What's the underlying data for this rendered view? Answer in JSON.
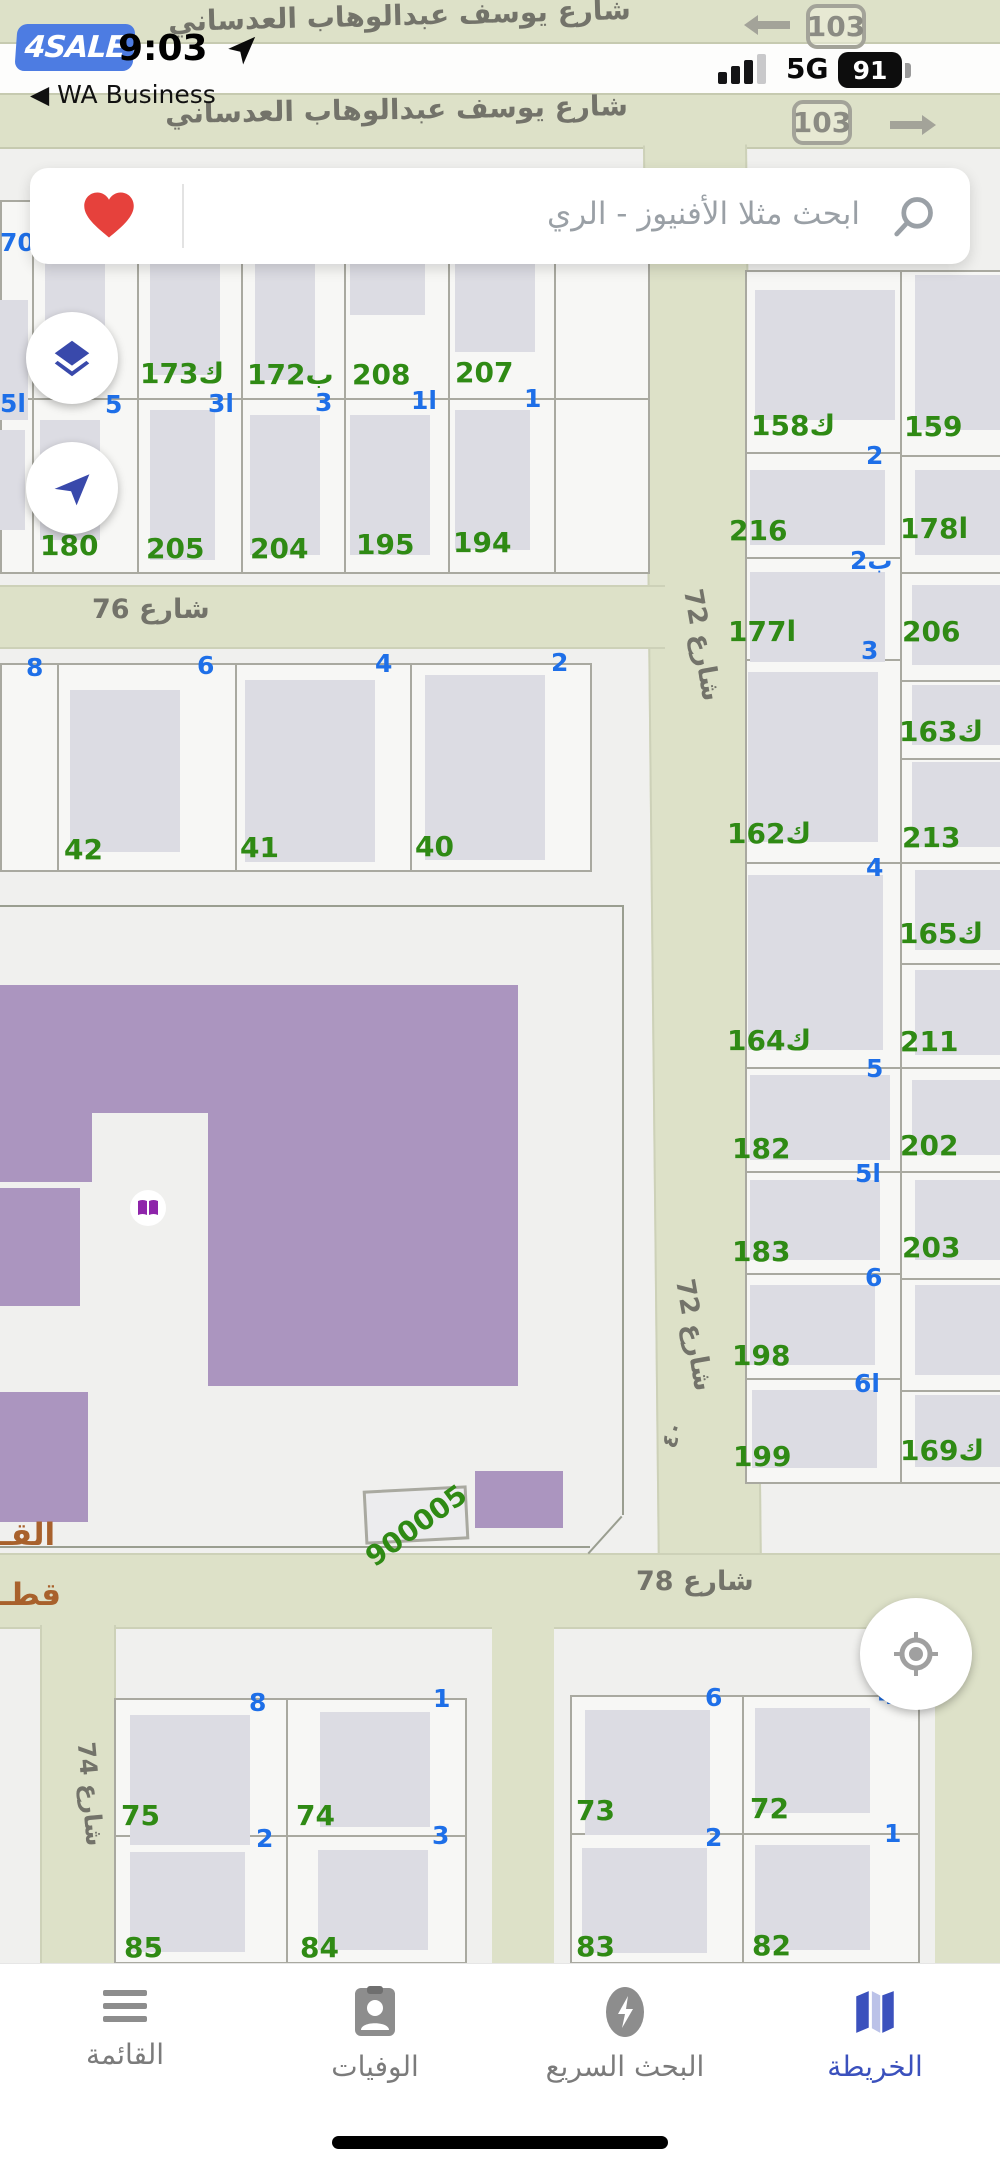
{
  "status_bar": {
    "app_badge": "4SALE",
    "time": "9:03",
    "back_label": "◀ WA Business",
    "network": "5G",
    "battery": "91"
  },
  "search": {
    "placeholder": "ابحث مثلا الأفنيوز - الري"
  },
  "map": {
    "road_badges": [
      {
        "text": "103"
      },
      {
        "text": "103"
      }
    ],
    "street_labels": [
      {
        "t": "شارع يوسف عبدالوهاب العدساني",
        "x": 168,
        "y": 2,
        "s": 28,
        "r": -1.5
      },
      {
        "t": "شارع يوسف عبدالوهاب العدساني",
        "x": 165,
        "y": 96,
        "s": 28,
        "r": -1
      },
      {
        "t": "شارع 76",
        "x": 92,
        "y": 596,
        "s": 27,
        "r": 0
      },
      {
        "t": "شارع 72",
        "x": 645,
        "y": 632,
        "s": 26,
        "r": 80
      },
      {
        "t": "شارع 72",
        "x": 637,
        "y": 1322,
        "s": 26,
        "r": 80
      },
      {
        "t": "شارع 78",
        "x": 636,
        "y": 1568,
        "s": 27,
        "r": 0
      },
      {
        "t": "شارع 74",
        "x": 38,
        "y": 1782,
        "s": 24,
        "r": 85
      },
      {
        "t": "٤٠",
        "x": 660,
        "y": 1424,
        "s": 22,
        "r": -72
      }
    ],
    "plot_numbers_green": [
      {
        "t": "173ك",
        "x": 140,
        "y": 360
      },
      {
        "t": "172ب",
        "x": 247,
        "y": 361
      },
      {
        "t": "208",
        "x": 352,
        "y": 361
      },
      {
        "t": "207",
        "x": 455,
        "y": 359
      },
      {
        "t": "180",
        "x": 40,
        "y": 532
      },
      {
        "t": "205",
        "x": 146,
        "y": 535
      },
      {
        "t": "204",
        "x": 250,
        "y": 535
      },
      {
        "t": "195",
        "x": 356,
        "y": 531
      },
      {
        "t": "194",
        "x": 453,
        "y": 529
      },
      {
        "t": "42",
        "x": 64,
        "y": 836
      },
      {
        "t": "41",
        "x": 240,
        "y": 834
      },
      {
        "t": "40",
        "x": 415,
        "y": 833
      },
      {
        "t": "158ك",
        "x": 751,
        "y": 412
      },
      {
        "t": "216",
        "x": 729,
        "y": 517
      },
      {
        "t": "177ا",
        "x": 728,
        "y": 618
      },
      {
        "t": "162ك",
        "x": 727,
        "y": 820
      },
      {
        "t": "164ك",
        "x": 727,
        "y": 1027
      },
      {
        "t": "182",
        "x": 732,
        "y": 1135
      },
      {
        "t": "183",
        "x": 732,
        "y": 1238
      },
      {
        "t": "198",
        "x": 732,
        "y": 1342
      },
      {
        "t": "199",
        "x": 733,
        "y": 1443
      },
      {
        "t": "159",
        "x": 904,
        "y": 413
      },
      {
        "t": "178ا",
        "x": 900,
        "y": 515
      },
      {
        "t": "206",
        "x": 902,
        "y": 618
      },
      {
        "t": "163ك",
        "x": 899,
        "y": 718
      },
      {
        "t": "213",
        "x": 902,
        "y": 824
      },
      {
        "t": "165ك",
        "x": 899,
        "y": 920
      },
      {
        "t": "211",
        "x": 900,
        "y": 1028
      },
      {
        "t": "202",
        "x": 900,
        "y": 1132
      },
      {
        "t": "203",
        "x": 902,
        "y": 1234
      },
      {
        "t": "169ك",
        "x": 900,
        "y": 1437
      },
      {
        "t": "75",
        "x": 121,
        "y": 1802
      },
      {
        "t": "74",
        "x": 296,
        "y": 1802
      },
      {
        "t": "73",
        "x": 576,
        "y": 1797
      },
      {
        "t": "72",
        "x": 750,
        "y": 1795
      },
      {
        "t": "85",
        "x": 124,
        "y": 1934
      },
      {
        "t": "84",
        "x": 300,
        "y": 1934
      },
      {
        "t": "83",
        "x": 576,
        "y": 1933
      },
      {
        "t": "82",
        "x": 752,
        "y": 1932
      },
      {
        "t": "900005",
        "x": 358,
        "y": 1512,
        "r": -36
      }
    ],
    "lot_numbers_blue": [
      {
        "t": "70ا",
        "x": 0,
        "y": 230
      },
      {
        "t": "5ا",
        "x": 0,
        "y": 391
      },
      {
        "t": "5",
        "x": 105,
        "y": 392
      },
      {
        "t": "3ا",
        "x": 208,
        "y": 391
      },
      {
        "t": "3",
        "x": 315,
        "y": 390
      },
      {
        "t": "1ا",
        "x": 411,
        "y": 388
      },
      {
        "t": "1",
        "x": 524,
        "y": 386
      },
      {
        "t": "2",
        "x": 866,
        "y": 443
      },
      {
        "t": "2ب",
        "x": 850,
        "y": 548
      },
      {
        "t": "3",
        "x": 861,
        "y": 638
      },
      {
        "t": "4",
        "x": 866,
        "y": 855
      },
      {
        "t": "5",
        "x": 866,
        "y": 1056
      },
      {
        "t": "5ا",
        "x": 855,
        "y": 1161
      },
      {
        "t": "6",
        "x": 865,
        "y": 1265
      },
      {
        "t": "6ا",
        "x": 854,
        "y": 1371
      },
      {
        "t": "8",
        "x": 26,
        "y": 655
      },
      {
        "t": "6",
        "x": 197,
        "y": 653
      },
      {
        "t": "4",
        "x": 375,
        "y": 651
      },
      {
        "t": "2",
        "x": 551,
        "y": 650
      },
      {
        "t": "8",
        "x": 249,
        "y": 1690
      },
      {
        "t": "1",
        "x": 433,
        "y": 1686
      },
      {
        "t": "2",
        "x": 256,
        "y": 1826
      },
      {
        "t": "3",
        "x": 432,
        "y": 1823
      },
      {
        "t": "6",
        "x": 705,
        "y": 1685
      },
      {
        "t": "4",
        "x": 878,
        "y": 1683
      },
      {
        "t": "2",
        "x": 705,
        "y": 1825
      },
      {
        "t": "1",
        "x": 884,
        "y": 1821
      }
    ],
    "district_labels_brown": [
      {
        "t": "القـ",
        "x": 0,
        "y": 1520
      },
      {
        "t": "قطـ",
        "x": 0,
        "y": 1580
      }
    ],
    "poi": {
      "school_marker": "open-book"
    }
  },
  "nav": {
    "tabs": [
      {
        "label": "القائمة",
        "active": false
      },
      {
        "label": "الوفيات",
        "active": false
      },
      {
        "label": "البحث السريع",
        "active": false
      },
      {
        "label": "الخريطة",
        "active": true
      }
    ]
  },
  "colors": {
    "accent_blue": "#3b51bd",
    "plot_green": "#2f8a14",
    "lot_blue": "#1e6fe8",
    "road_beige": "#dde1c8",
    "school_purple": "#ab95bf",
    "heart_red": "#e6413c",
    "badge_blue": "#4d7ce2",
    "district_brown": "#a8612c"
  }
}
